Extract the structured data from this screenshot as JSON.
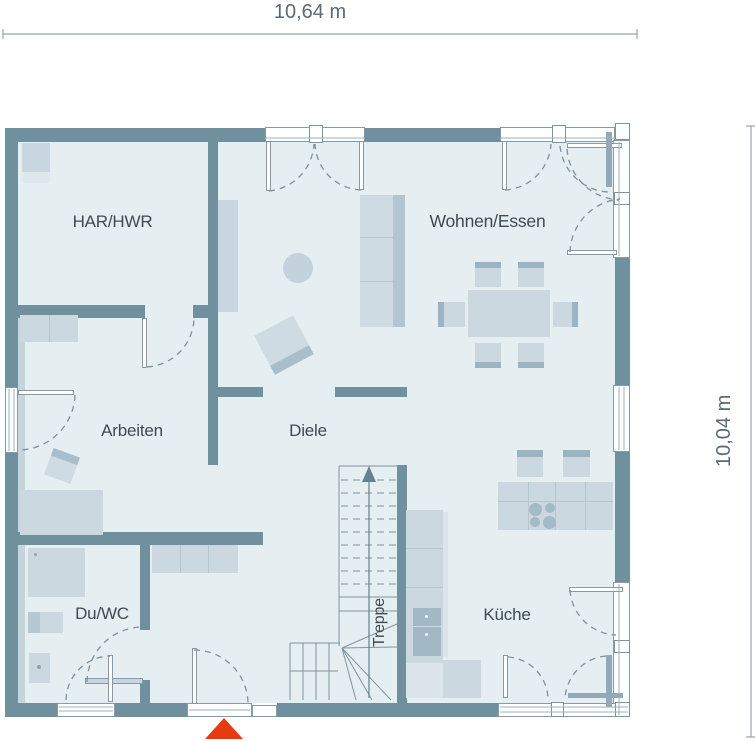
{
  "dimensions": {
    "width_label": "10,64 m",
    "height_label": "10,04 m"
  },
  "rooms": {
    "har_hwr": "HAR/HWR",
    "wohnen_essen": "Wohnen/Essen",
    "arbeiten": "Arbeiten",
    "diele": "Diele",
    "du_wc": "Du/WC",
    "kueche": "Küche",
    "treppe": "Treppe"
  },
  "colors": {
    "wall": "#71909e",
    "floor": "#e5eff1",
    "furniture": "#ccd8e0",
    "furniture_accent": "#9cb3c1",
    "glass_frame": "#8a9aa5",
    "entrance_marker": "#e73a10",
    "label_text": "#3e4b53",
    "dimension_text": "#5b6a73"
  }
}
